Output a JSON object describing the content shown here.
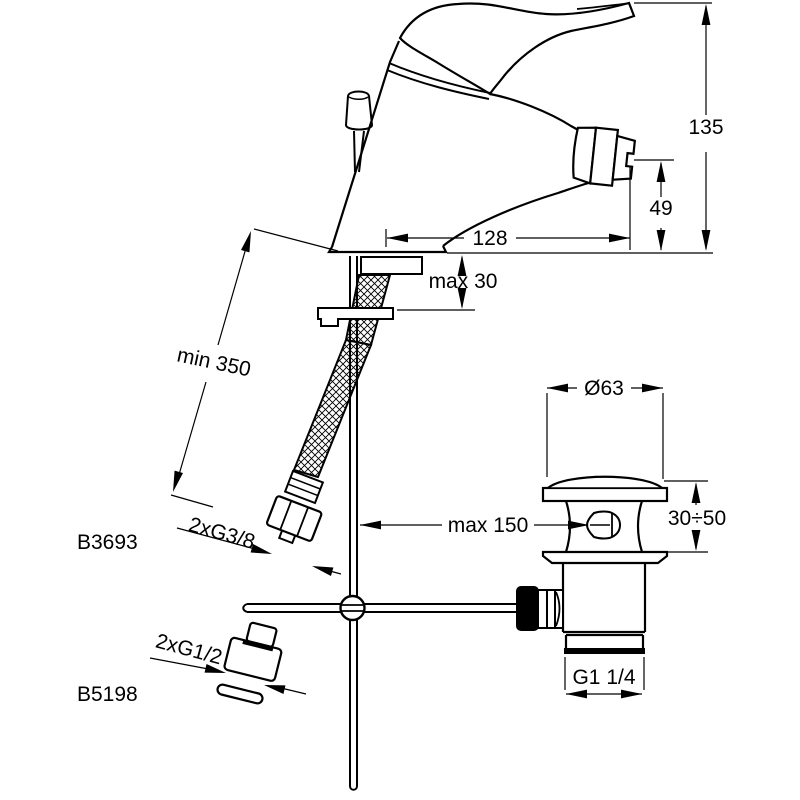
{
  "page": {
    "background": "#ffffff",
    "line_color": "#000000",
    "description": "bidet single-lever mixer technical dimension drawing"
  },
  "labels": {
    "height_total": "135",
    "spout_height": "49",
    "spout_reach": "128",
    "deck_thickness": "max 30",
    "hose_length": "min 350",
    "hose_connection": "2xG3/8",
    "product_code_mixer": "B3693",
    "rod_distance": "max 150",
    "plug_diameter": "Ø63",
    "mounting_range": "30÷50",
    "adapter_connection": "2xG1/2",
    "product_code_adapter": "B5198",
    "waste_thread": "G1 1/4"
  }
}
